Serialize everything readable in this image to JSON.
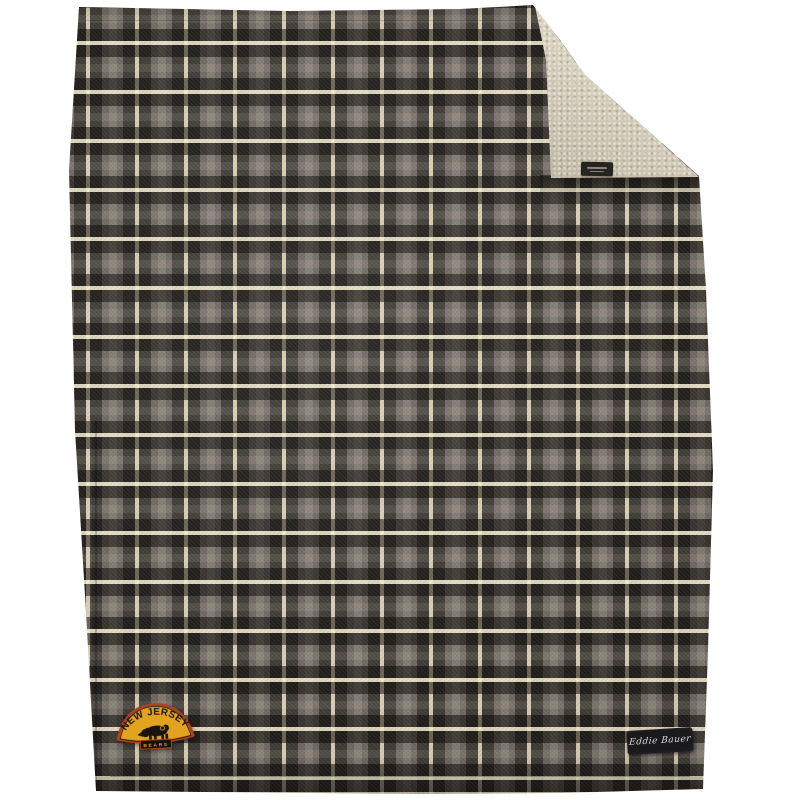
{
  "scene": {
    "type": "product-photo",
    "background_color": "#ffffff",
    "subject": "plaid fleece throw blanket with folded sherpa corner"
  },
  "blanket": {
    "plaid_colors": {
      "gray": "#6d6660",
      "dark": "#332f2b",
      "cream": "#e9dfc2",
      "light_gray": "#837c74"
    },
    "sherpa_color": "#d8d1be",
    "patch": {
      "arch_text": "NEW JERSEY",
      "banner_text": "BEARS",
      "gold": "#e2a41e",
      "border_orange": "#a84420",
      "ink": "#1a1410"
    },
    "brand_label": {
      "text": "Eddie Bauer",
      "background": "#1a1a1c",
      "text_color": "#dddddd"
    }
  }
}
